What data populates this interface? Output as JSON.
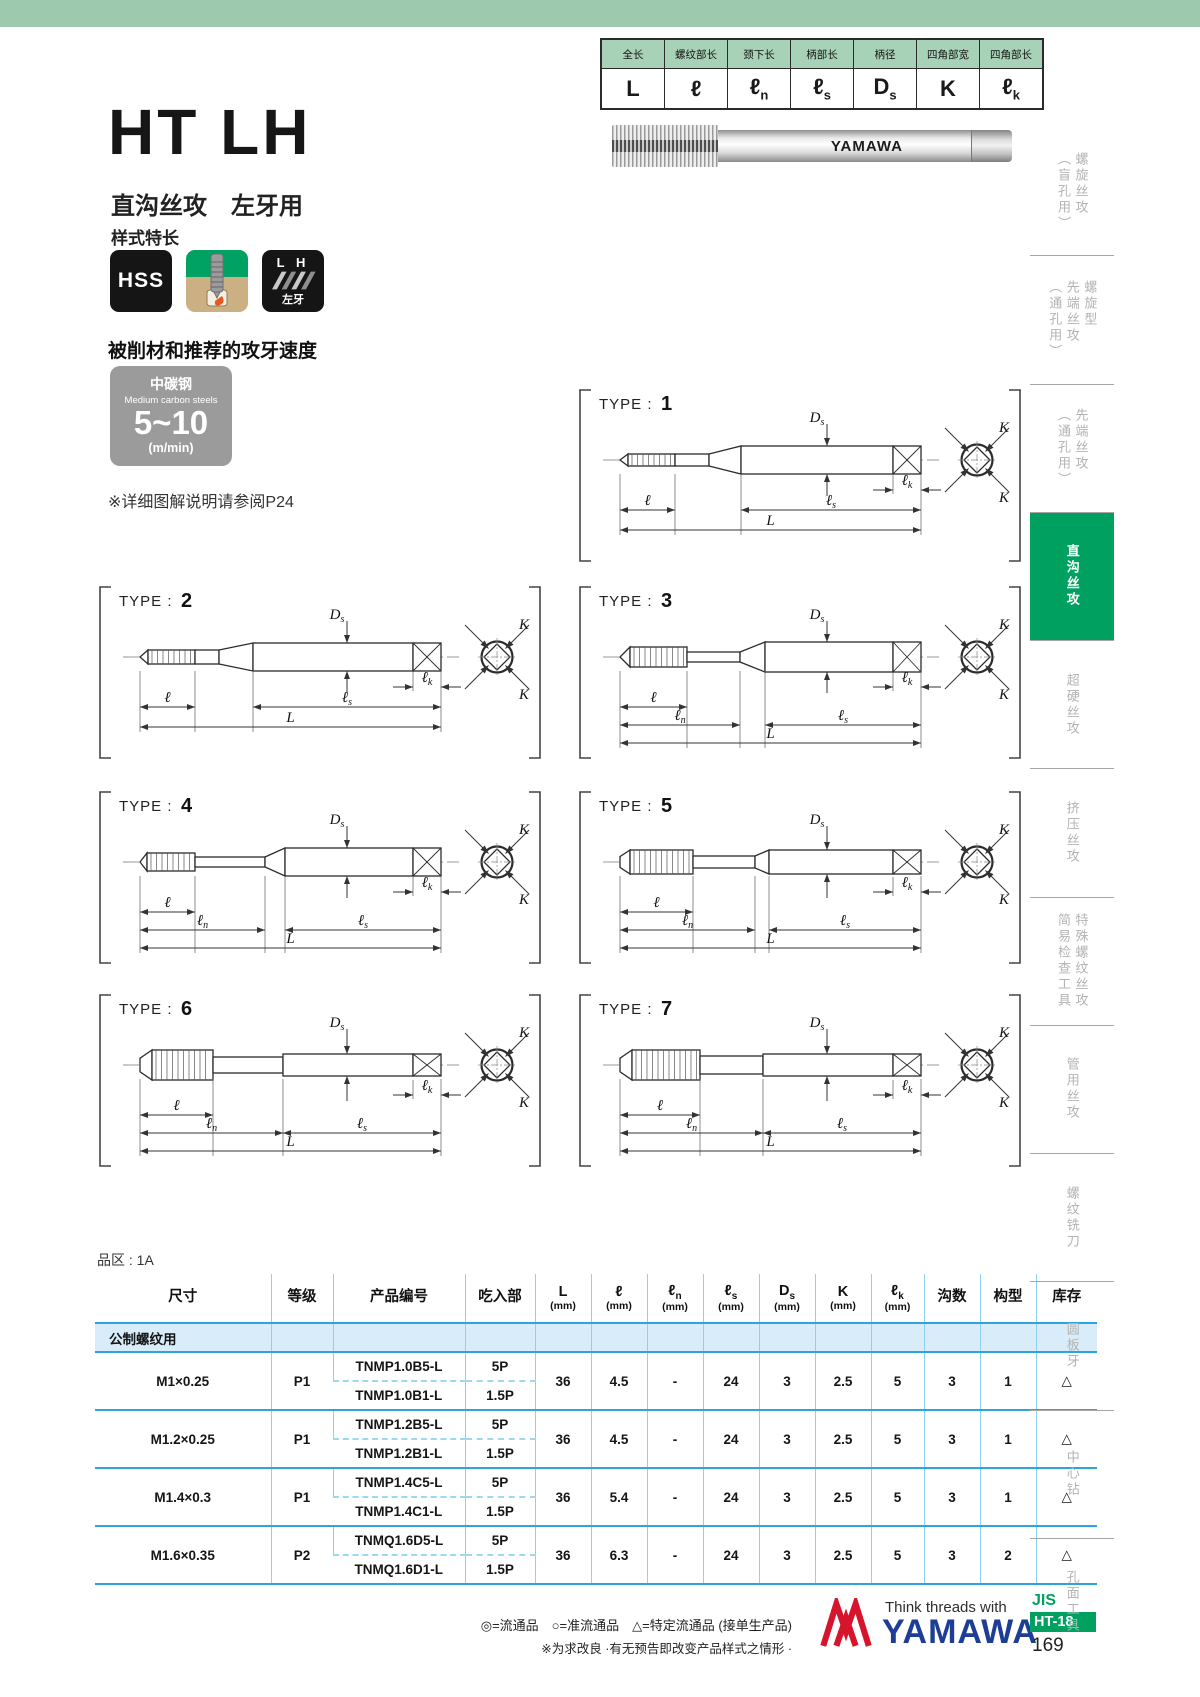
{
  "page": {
    "title": "HT LH",
    "subtitle": "直沟丝攻　左牙用",
    "features_label": "样式特长",
    "speed_heading": "被削材和推荐的攻牙速度",
    "speed_card": {
      "material_cn": "中碳钢",
      "material_en": "Medium carbon steels",
      "range": "5~10",
      "unit": "(m/min)"
    },
    "note": "※详细图解说明请参阅P24",
    "region_label": "品区 : 1A"
  },
  "icons": {
    "hss": "HSS",
    "lh_top": "L H",
    "lh_bottom": "左牙"
  },
  "photo": {
    "brand": "YAMAWA"
  },
  "spec_table": {
    "cols": [
      {
        "cn": "全长",
        "base": "L",
        "sub": ""
      },
      {
        "cn": "螺纹部长",
        "base": "ℓ",
        "sub": ""
      },
      {
        "cn": "颈下长",
        "base": "ℓ",
        "sub": "n"
      },
      {
        "cn": "柄部长",
        "base": "ℓ",
        "sub": "s"
      },
      {
        "cn": "柄径",
        "base": "D",
        "sub": "s"
      },
      {
        "cn": "四角部宽",
        "base": "K",
        "sub": ""
      },
      {
        "cn": "四角部长",
        "base": "ℓ",
        "sub": "k"
      }
    ]
  },
  "sidebar": {
    "tabs": [
      {
        "label": "螺旋丝攻\n（盲孔用）",
        "active": false
      },
      {
        "label": "螺旋型\n先端丝攻\n（通孔用）",
        "active": false
      },
      {
        "label": "先端丝攻\n（通孔用）",
        "active": false
      },
      {
        "label": "直沟丝攻",
        "active": true
      },
      {
        "label": "超硬丝攻",
        "active": false
      },
      {
        "label": "挤压丝攻",
        "active": false
      },
      {
        "label": "特殊螺纹丝攻\n简易检查工具",
        "active": false
      },
      {
        "label": "管用丝攻",
        "active": false
      },
      {
        "label": "螺纹铣刀",
        "active": false
      },
      {
        "label": "圆板牙",
        "active": false
      },
      {
        "label": "中心钻",
        "active": false
      },
      {
        "label": "孔面工具",
        "active": false
      }
    ]
  },
  "diagrams": {
    "type_prefix": "TYPE : ",
    "dim_labels": {
      "l": [
        "ℓ",
        ""
      ],
      "ln": [
        "ℓ",
        "n"
      ],
      "ls": [
        "ℓ",
        "s"
      ],
      "lk": [
        "ℓ",
        "k"
      ],
      "L": [
        "L",
        ""
      ],
      "Ds": [
        "D",
        "s"
      ],
      "K": [
        "K",
        ""
      ]
    },
    "types": [
      {
        "num": "1",
        "variant": 1,
        "dims": [
          "l",
          "ls",
          "lk",
          "L"
        ]
      },
      {
        "num": "2",
        "variant": 2,
        "dims": [
          "l",
          "ls",
          "lk",
          "L"
        ]
      },
      {
        "num": "3",
        "variant": 3,
        "dims": [
          "l",
          "ln",
          "ls",
          "lk",
          "L"
        ]
      },
      {
        "num": "4",
        "variant": 4,
        "dims": [
          "l",
          "ln",
          "ls",
          "lk",
          "L"
        ]
      },
      {
        "num": "5",
        "variant": 5,
        "dims": [
          "l",
          "ln",
          "ls",
          "lk",
          "L"
        ]
      },
      {
        "num": "6",
        "variant": 6,
        "dims": [
          "l",
          "ln",
          "ls",
          "lk",
          "L"
        ]
      },
      {
        "num": "7",
        "variant": 7,
        "dims": [
          "l",
          "ln",
          "ls",
          "lk",
          "L"
        ]
      }
    ]
  },
  "table": {
    "headers": [
      {
        "t": "尺寸"
      },
      {
        "t": "等级"
      },
      {
        "t": "产品编号"
      },
      {
        "t": "吃入部"
      },
      {
        "base": "L",
        "sub": "",
        "unit": "(mm)"
      },
      {
        "base": "ℓ",
        "sub": "",
        "unit": "(mm)"
      },
      {
        "base": "ℓ",
        "sub": "n",
        "unit": "(mm)"
      },
      {
        "base": "ℓ",
        "sub": "s",
        "unit": "(mm)"
      },
      {
        "base": "D",
        "sub": "s",
        "unit": "(mm)"
      },
      {
        "base": "K",
        "sub": "",
        "unit": "(mm)"
      },
      {
        "base": "ℓ",
        "sub": "k",
        "unit": "(mm)"
      },
      {
        "t": "沟数"
      },
      {
        "t": "构型"
      },
      {
        "t": "库存"
      }
    ],
    "section_label": "公制螺纹用",
    "rows": [
      {
        "size": "M1×0.25",
        "grade": "P1",
        "items": [
          [
            "TNMP1.0B5-L",
            "5P"
          ],
          [
            "TNMP1.0B1-L",
            "1.5P"
          ]
        ],
        "vals": [
          "36",
          "4.5",
          "-",
          "24",
          "3",
          "2.5",
          "5",
          "3",
          "1",
          "△"
        ]
      },
      {
        "size": "M1.2×0.25",
        "grade": "P1",
        "items": [
          [
            "TNMP1.2B5-L",
            "5P"
          ],
          [
            "TNMP1.2B1-L",
            "1.5P"
          ]
        ],
        "vals": [
          "36",
          "4.5",
          "-",
          "24",
          "3",
          "2.5",
          "5",
          "3",
          "1",
          "△"
        ]
      },
      {
        "size": "M1.4×0.3",
        "grade": "P1",
        "items": [
          [
            "TNMP1.4C5-L",
            "5P"
          ],
          [
            "TNMP1.4C1-L",
            "1.5P"
          ]
        ],
        "vals": [
          "36",
          "5.4",
          "-",
          "24",
          "3",
          "2.5",
          "5",
          "3",
          "1",
          "△"
        ]
      },
      {
        "size": "M1.6×0.35",
        "grade": "P2",
        "items": [
          [
            "TNMQ1.6D5-L",
            "5P"
          ],
          [
            "TNMQ1.6D1-L",
            "1.5P"
          ]
        ],
        "vals": [
          "36",
          "6.3",
          "-",
          "24",
          "3",
          "2.5",
          "5",
          "3",
          "2",
          "△"
        ]
      }
    ]
  },
  "footer": {
    "legend1": "◎=流通品　○=准流通品　△=特定流通品 (接单生产品)",
    "legend2": "※为求改良 ·有无预告即改变产品样式之情形 ·",
    "tagline": "Think threads with",
    "brand": "YAMAWA",
    "jis": "JIS",
    "doc_code": "HT-18",
    "page_number": "169"
  }
}
